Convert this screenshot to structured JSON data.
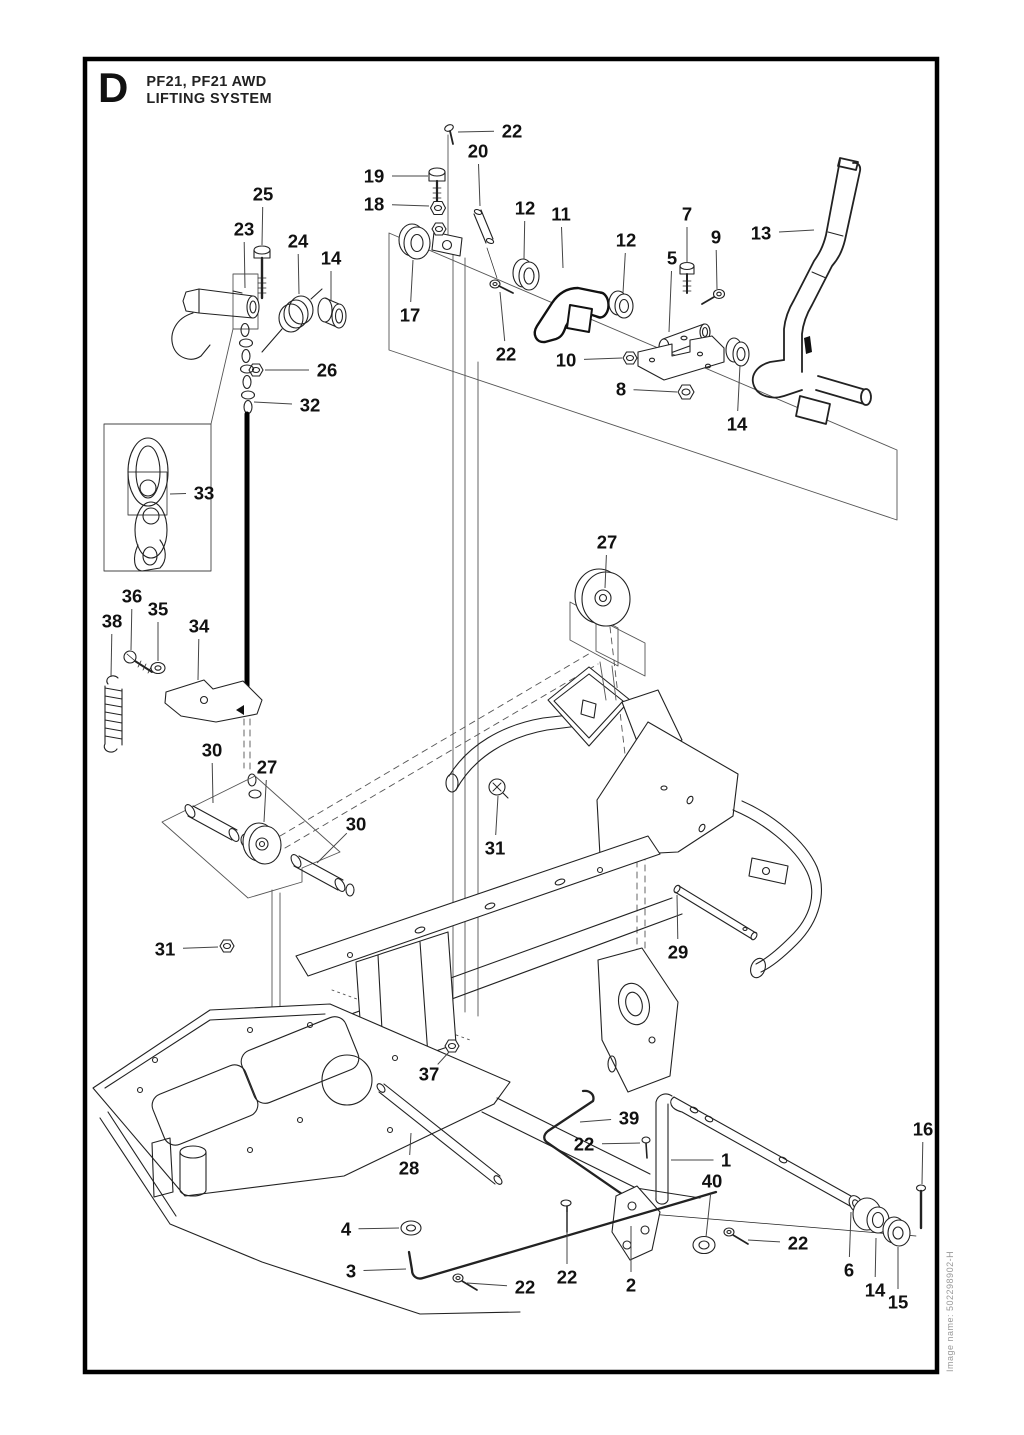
{
  "page": {
    "section_letter": "D",
    "title_line1": "PF21, PF21 AWD",
    "title_line2": "LIFTING SYSTEM",
    "image_name": "Image name: 502298902-H"
  },
  "diagram": {
    "description": "Exploded-view parts drawing of the lifting system with numbered callouts",
    "callouts": [
      {
        "label": "22",
        "x": 512,
        "y": 131,
        "tx": 458,
        "ty": 132
      },
      {
        "label": "20",
        "x": 478,
        "y": 151,
        "tx": 480,
        "ty": 206
      },
      {
        "label": "19",
        "x": 374,
        "y": 176,
        "tx": 428,
        "ty": 176
      },
      {
        "label": "18",
        "x": 374,
        "y": 204,
        "tx": 429,
        "ty": 206
      },
      {
        "label": "25",
        "x": 263,
        "y": 194,
        "tx": 262,
        "ty": 245
      },
      {
        "label": "23",
        "x": 244,
        "y": 229,
        "tx": 245,
        "ty": 288
      },
      {
        "label": "24",
        "x": 298,
        "y": 241,
        "tx": 299,
        "ty": 294
      },
      {
        "label": "14",
        "x": 331,
        "y": 258,
        "tx": 331,
        "ty": 300
      },
      {
        "label": "12",
        "x": 525,
        "y": 208,
        "tx": 524,
        "ty": 259
      },
      {
        "label": "11",
        "x": 561,
        "y": 214,
        "tx": 563,
        "ty": 268
      },
      {
        "label": "12",
        "x": 626,
        "y": 240,
        "tx": 623,
        "ty": 293
      },
      {
        "label": "7",
        "x": 687,
        "y": 214,
        "tx": 687,
        "ty": 263
      },
      {
        "label": "9",
        "x": 716,
        "y": 237,
        "tx": 717,
        "ty": 289
      },
      {
        "label": "13",
        "x": 761,
        "y": 233,
        "tx": 814,
        "ty": 230
      },
      {
        "label": "5",
        "x": 672,
        "y": 258,
        "tx": 669,
        "ty": 332
      },
      {
        "label": "17",
        "x": 410,
        "y": 315,
        "tx": 413,
        "ty": 260
      },
      {
        "label": "22",
        "x": 506,
        "y": 354,
        "tx": 500,
        "ty": 292
      },
      {
        "label": "10",
        "x": 566,
        "y": 360,
        "tx": 622,
        "ty": 358
      },
      {
        "label": "8",
        "x": 621,
        "y": 389,
        "tx": 677,
        "ty": 392
      },
      {
        "label": "14",
        "x": 737,
        "y": 424,
        "tx": 740,
        "ty": 365
      },
      {
        "label": "26",
        "x": 327,
        "y": 370,
        "tx": 265,
        "ty": 370
      },
      {
        "label": "32",
        "x": 310,
        "y": 405,
        "tx": 254,
        "ty": 402
      },
      {
        "label": "33",
        "x": 204,
        "y": 493,
        "tx": 170,
        "ty": 494
      },
      {
        "label": "27",
        "x": 607,
        "y": 542,
        "tx": 605,
        "ty": 588
      },
      {
        "label": "36",
        "x": 132,
        "y": 596,
        "tx": 131,
        "ty": 650
      },
      {
        "label": "35",
        "x": 158,
        "y": 609,
        "tx": 158,
        "ty": 661
      },
      {
        "label": "38",
        "x": 112,
        "y": 621,
        "tx": 111,
        "ty": 677
      },
      {
        "label": "34",
        "x": 199,
        "y": 626,
        "tx": 198,
        "ty": 680
      },
      {
        "label": "30",
        "x": 212,
        "y": 750,
        "tx": 213,
        "ty": 803
      },
      {
        "label": "27",
        "x": 267,
        "y": 767,
        "tx": 264,
        "ty": 822
      },
      {
        "label": "30",
        "x": 356,
        "y": 824,
        "tx": 317,
        "ty": 863
      },
      {
        "label": "31",
        "x": 495,
        "y": 848,
        "tx": 498,
        "ty": 796
      },
      {
        "label": "31",
        "x": 165,
        "y": 949,
        "tx": 218,
        "ty": 947
      },
      {
        "label": "29",
        "x": 678,
        "y": 952,
        "tx": 677,
        "ty": 895
      },
      {
        "label": "37",
        "x": 429,
        "y": 1074,
        "tx": 449,
        "ty": 1052
      },
      {
        "label": "39",
        "x": 629,
        "y": 1118,
        "tx": 580,
        "ty": 1122
      },
      {
        "label": "22",
        "x": 584,
        "y": 1144,
        "tx": 640,
        "ty": 1143
      },
      {
        "label": "1",
        "x": 726,
        "y": 1160,
        "tx": 671,
        "ty": 1160
      },
      {
        "label": "16",
        "x": 923,
        "y": 1129,
        "tx": 922,
        "ty": 1184
      },
      {
        "label": "40",
        "x": 712,
        "y": 1181,
        "tx": 706,
        "ty": 1237
      },
      {
        "label": "28",
        "x": 409,
        "y": 1168,
        "tx": 411,
        "ty": 1133
      },
      {
        "label": "4",
        "x": 346,
        "y": 1229,
        "tx": 399,
        "ty": 1228
      },
      {
        "label": "3",
        "x": 351,
        "y": 1271,
        "tx": 406,
        "ty": 1269
      },
      {
        "label": "22",
        "x": 525,
        "y": 1287,
        "tx": 467,
        "ty": 1283
      },
      {
        "label": "22",
        "x": 567,
        "y": 1277,
        "tx": 567,
        "ty": 1212
      },
      {
        "label": "2",
        "x": 631,
        "y": 1285,
        "tx": 631,
        "ty": 1226
      },
      {
        "label": "22",
        "x": 798,
        "y": 1243,
        "tx": 748,
        "ty": 1240
      },
      {
        "label": "6",
        "x": 849,
        "y": 1270,
        "tx": 851,
        "ty": 1212
      },
      {
        "label": "14",
        "x": 875,
        "y": 1290,
        "tx": 876,
        "ty": 1238
      },
      {
        "label": "15",
        "x": 898,
        "y": 1302,
        "tx": 898,
        "ty": 1247
      }
    ]
  }
}
